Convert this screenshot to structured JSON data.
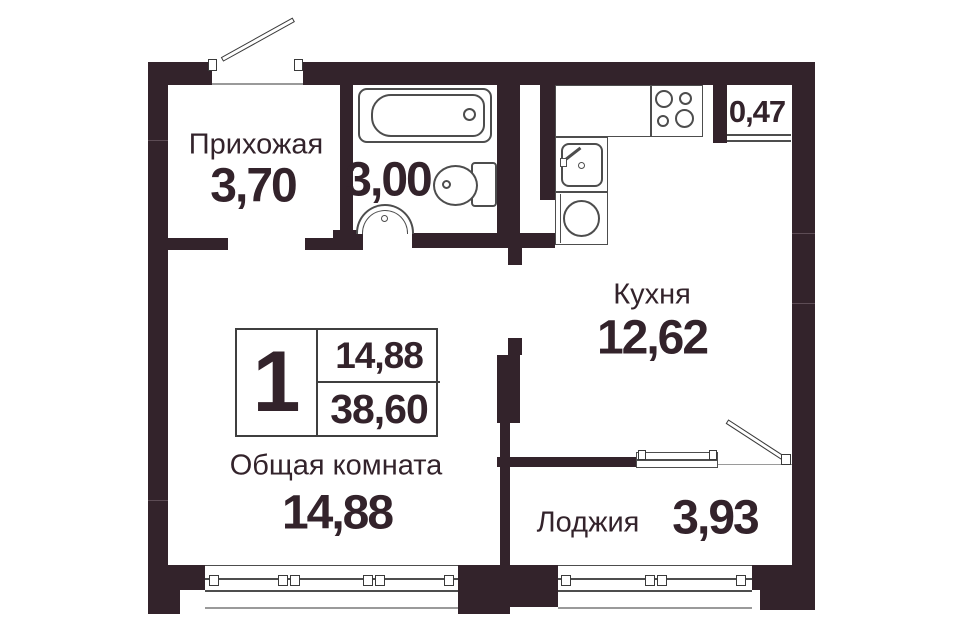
{
  "plan": {
    "unit": {
      "rooms_count": "1",
      "living_area": "14,88",
      "total_area": "38,60"
    },
    "rooms": {
      "hallway": {
        "name": "Прихожая",
        "area": "3,70"
      },
      "bathroom": {
        "area": "3,00"
      },
      "kitchen": {
        "name": "Кухня",
        "area": "12,62"
      },
      "living": {
        "name": "Общая комната",
        "area": "14,88"
      },
      "loggia": {
        "name": "Лоджия",
        "area": "3,93"
      },
      "closet": {
        "area": "0,47"
      }
    },
    "colors": {
      "wall": "#33232b",
      "fixture_outline": "#4d4d4d",
      "background": "#ffffff"
    }
  }
}
